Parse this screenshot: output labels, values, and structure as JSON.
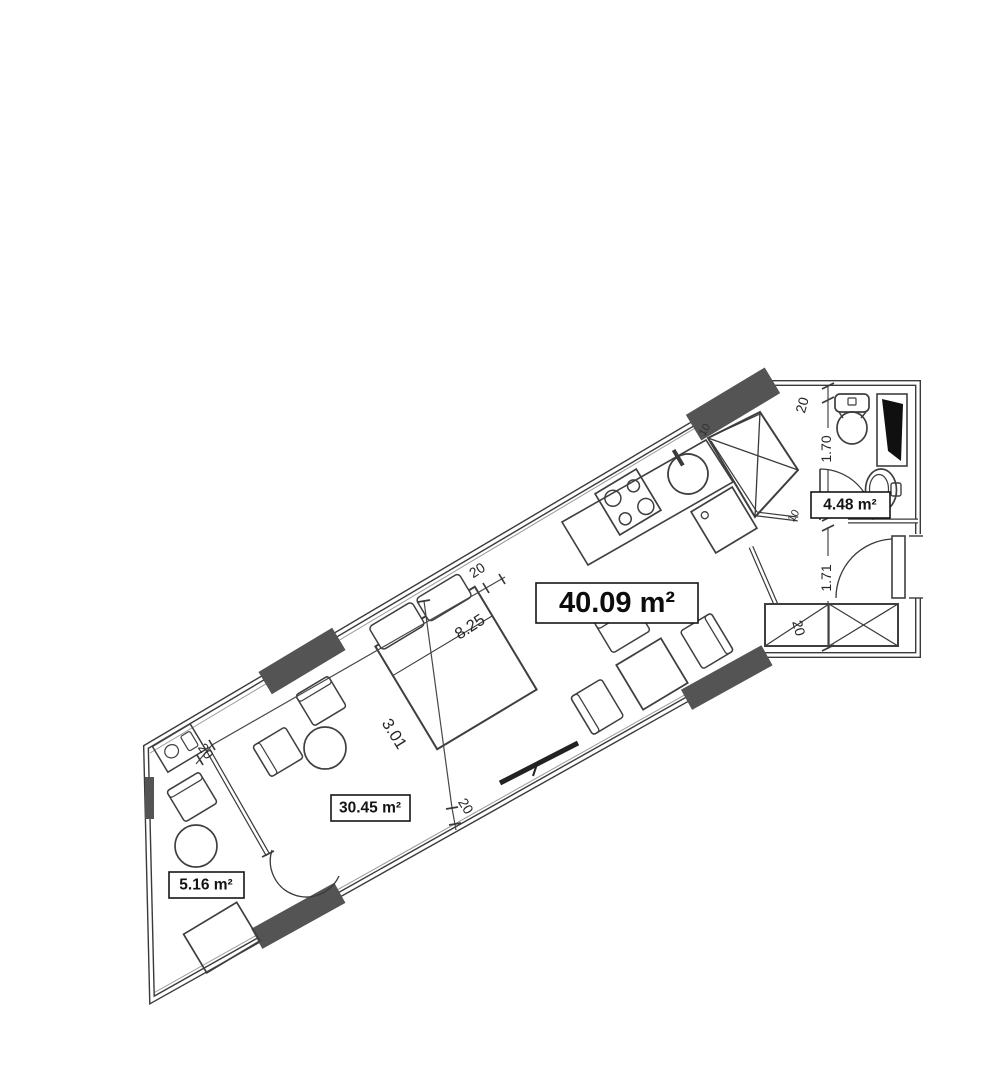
{
  "plan": {
    "kind": "apartment-floor-plan",
    "areas": {
      "total": "40.09 m²",
      "room": "30.45 m²",
      "balcony": "5.16 m²",
      "bathroom": "4.48 m²"
    },
    "dimensions": {
      "length": "8.25",
      "width": "3.01",
      "bathroom_width": "1.70",
      "hall_width": "1.71",
      "wall_ticks": [
        "20",
        "20",
        "20",
        "20",
        "20"
      ],
      "thin_ticks": [
        "10",
        "10"
      ]
    },
    "colors": {
      "line": "#3a3a3a",
      "window_pier": "#545454",
      "shaft_fill": "#101010",
      "paper": "#ffffff",
      "text": "#1a1a1a"
    }
  }
}
